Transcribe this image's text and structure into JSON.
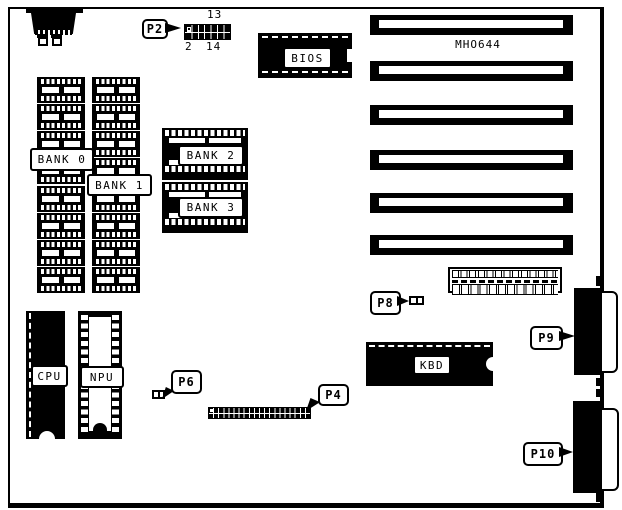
{
  "board": {
    "model": "MHO644",
    "callouts": {
      "p2": "P2",
      "p4": "P4",
      "p6": "P6",
      "p8": "P8",
      "p9": "P9",
      "p10": "P10"
    },
    "p2_header": {
      "pin13": "13",
      "pin2": "2",
      "pin14": "14"
    },
    "chips": {
      "bios": "BIOS",
      "cpu": "CPU",
      "npu": "NPU",
      "kbd": "KBD"
    },
    "banks": {
      "bank0": "BANK 0",
      "bank1": "BANK 1",
      "bank2": "BANK 2",
      "bank3": "BANK 3"
    },
    "colors": {
      "ink": "#000000",
      "paper": "#ffffff"
    }
  }
}
